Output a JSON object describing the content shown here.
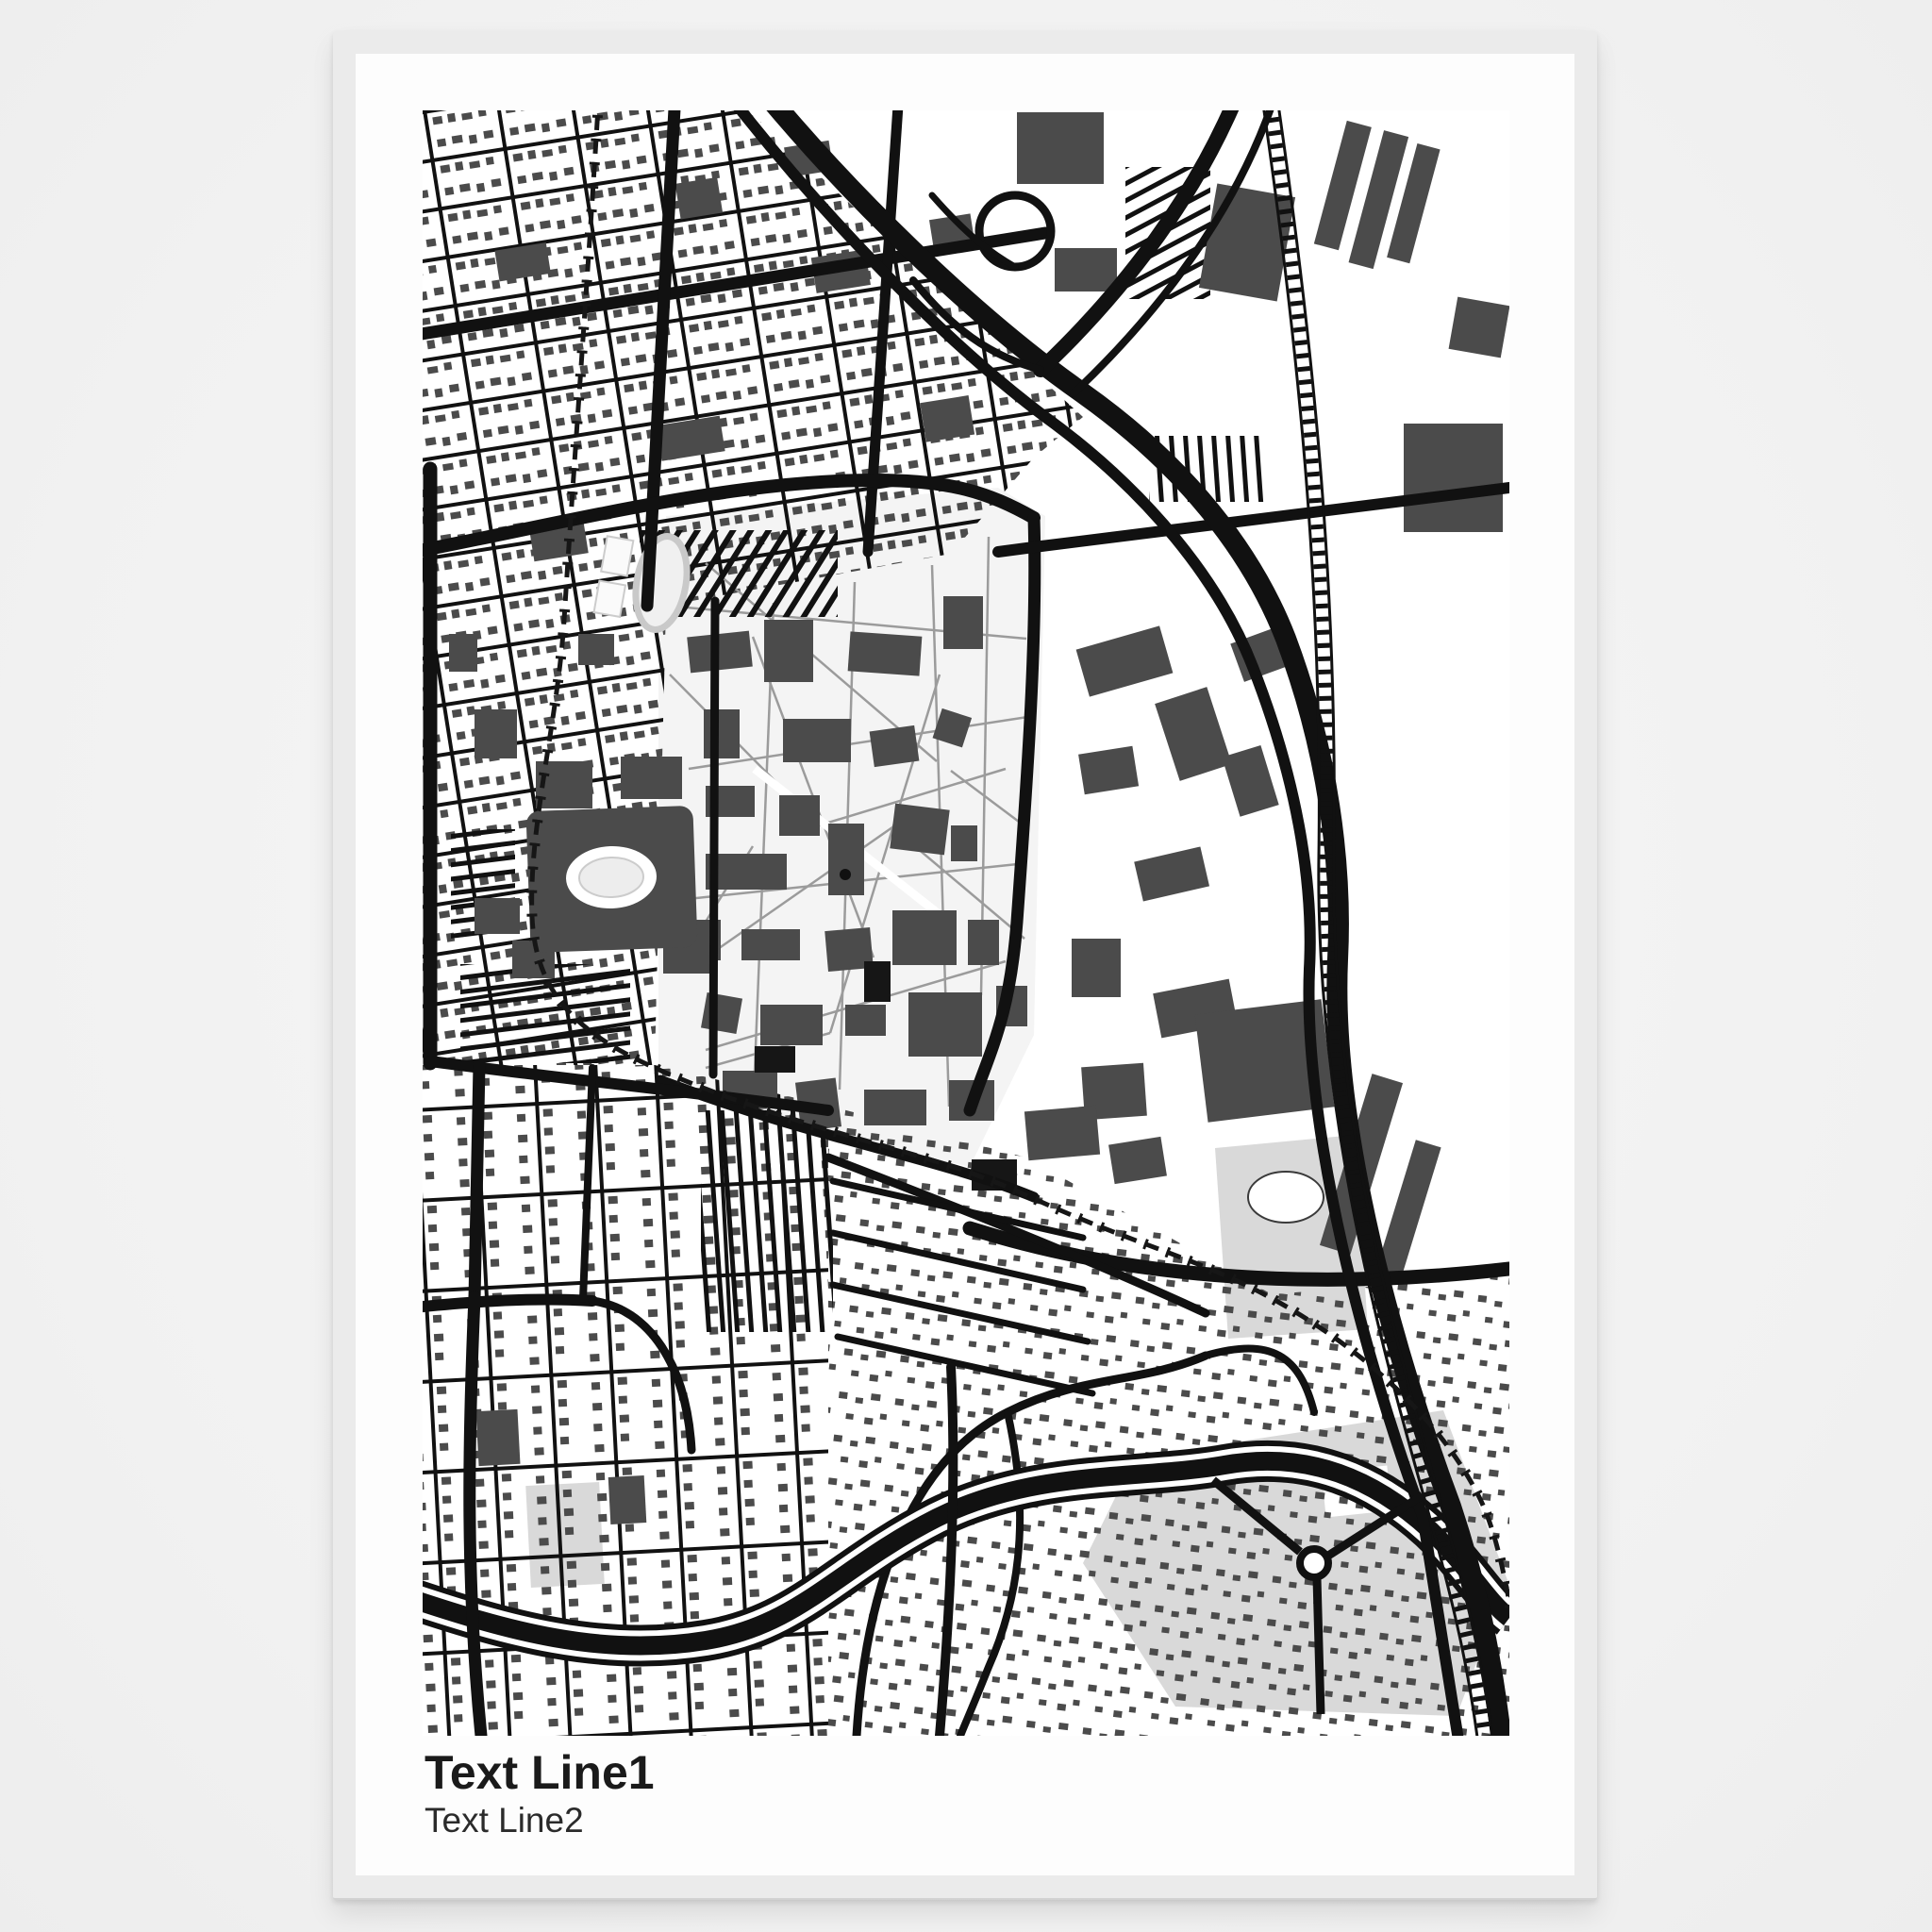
{
  "poster": {
    "title": "Text Line1",
    "subtitle": "Text Line2",
    "type": "framed-map-poster-mockup",
    "map_style": "black and white street map",
    "features": [
      "dense tilted residential street grid with small houses (north-west)",
      "university campus with dark buildings and footpath web (center)",
      "large stadium with white oval field and striped parking lots (west)",
      "running track oval (north of stadium)",
      "freeway bundle with loop ramp interchange (north-east)",
      "main railway corridor with tie marks (east)",
      "dot-dash rail line curving around campus (west and south)",
      "winding river with bank lines (south)",
      "light gray parks with pond and roundabout (south-east)",
      "curvy suburban streets with scattered houses (south)"
    ]
  },
  "colors": {
    "page_bg": "#f4f4f4",
    "frame": "#ebebeb",
    "paper": "#fdfdfd",
    "road": "#111111",
    "building": "#4b4b4b",
    "building_dark": "#161616",
    "park": "#d9d9d9",
    "path": "#9b9b9b",
    "campus": "#f4f4f4",
    "title": "#1a1a1a",
    "subtitle": "#2b2b2b"
  }
}
